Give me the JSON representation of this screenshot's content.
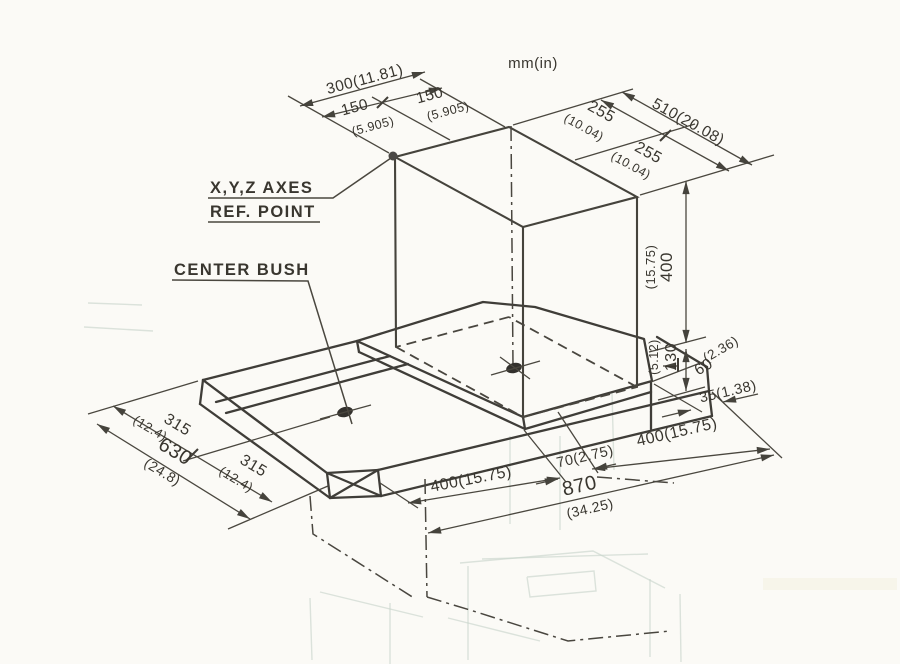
{
  "drawing": {
    "units_note": "mm(in)"
  },
  "callouts": {
    "axes_ref_line1": "X,Y,Z AXES",
    "axes_ref_line2": "REF. POINT",
    "center_bush": "CENTER BUSH"
  },
  "dims": {
    "top_width": {
      "total": "300(11.81)",
      "left_mm": "150",
      "left_in": "(5.905)",
      "right_mm": "150",
      "right_in": "(5.905)"
    },
    "top_depth": {
      "front_mm": "255",
      "front_in": "(10.04)",
      "total": "510(20.08)",
      "back_mm": "255",
      "back_in": "(10.04)"
    },
    "heights": {
      "z_mm": "400",
      "z_in": "(15.75)",
      "table_mm": "130",
      "table_in": "(5.12)",
      "step_mm": "60",
      "step_in": "(2.36)",
      "edge": "35(1.38)"
    },
    "front_edge": {
      "left": "400(15.75)",
      "center": "70(2.75)",
      "right": "400(15.75)",
      "total_mm": "870",
      "total_in": "(34.25)"
    },
    "left_edge": {
      "front_mm": "315",
      "front_in": "(12.4)",
      "total_mm": "630",
      "total_in": "(24.8)",
      "back_mm": "315",
      "back_in": "(12.4)"
    }
  }
}
